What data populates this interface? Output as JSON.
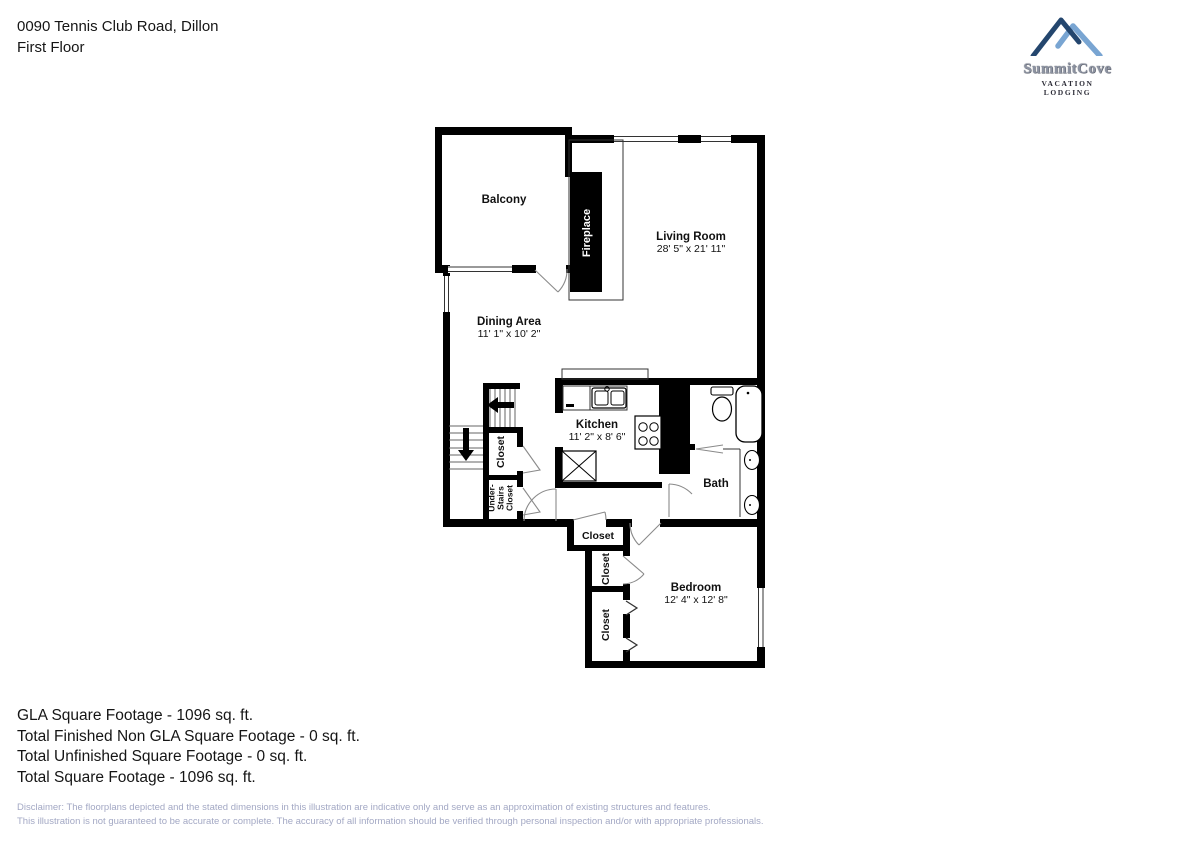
{
  "header": {
    "address": "0090 Tennis Club Road, Dillon",
    "floor": "First Floor"
  },
  "logo": {
    "brand": "SummitCove",
    "tagline": "VACATION LODGING"
  },
  "rooms": {
    "balcony": {
      "name": "Balcony"
    },
    "fireplace": {
      "name": "Fireplace"
    },
    "living_room": {
      "name": "Living Room",
      "dims": "28' 5\" x 21' 11\""
    },
    "dining_area": {
      "name": "Dining Area",
      "dims": "11' 1\" x 10' 2\""
    },
    "kitchen": {
      "name": "Kitchen",
      "dims": "11' 2\" x 8' 6\""
    },
    "bath": {
      "name": "Bath"
    },
    "bedroom": {
      "name": "Bedroom",
      "dims": "12' 4\" x 12' 8\""
    },
    "stairs_closet": {
      "name": "Closet"
    },
    "under_stairs_closet": {
      "line1": "Under-",
      "line2": "Stairs",
      "line3": "Closet"
    },
    "hall_closet": {
      "name": "Closet"
    },
    "bedroom_closet_small": {
      "name": "Closet"
    },
    "bedroom_closet_large": {
      "name": "Closet"
    }
  },
  "summary": {
    "gla": "GLA Square Footage - 1096 sq. ft.",
    "non_gla": "Total Finished Non GLA Square Footage - 0 sq. ft.",
    "unfinished": "Total Unfinished Square Footage - 0 sq. ft.",
    "total": "Total Square Footage - 1096 sq. ft."
  },
  "disclaimer": {
    "line1": "Disclaimer: The floorplans depicted and the stated dimensions in this illustration are indicative only and serve as an approximation of existing structures and features.",
    "line2": "This illustration is not guaranteed to be accurate or complete. The accuracy of all information should be verified through personal inspection and/or with appropriate professionals."
  }
}
